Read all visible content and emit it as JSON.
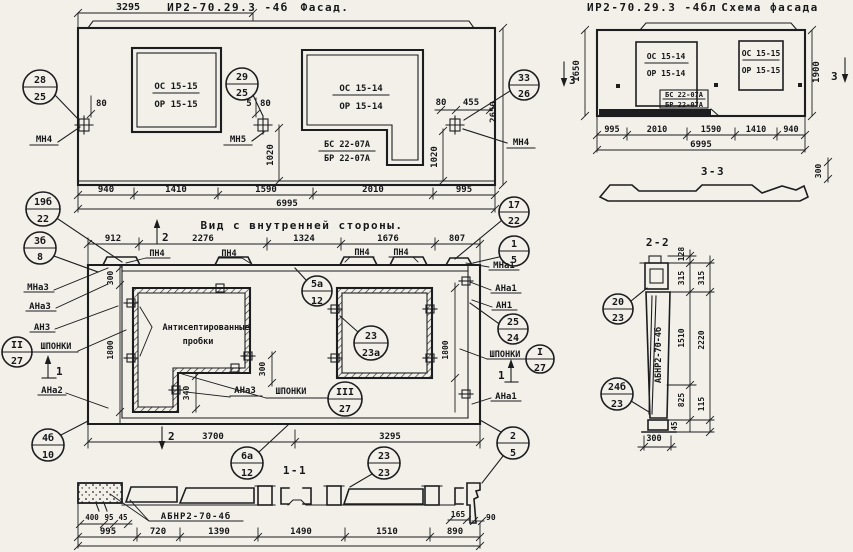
{
  "facade": {
    "mark": "ИР2-70.29.3 -4б",
    "title": "Фасад.",
    "dim_top": "3295",
    "win1_t": "ОС 15-15",
    "win1_b": "ОР 15-15",
    "win2_t": "ОС 15-14",
    "win2_b": "ОР 15-14",
    "door_t": "БС 22-07А",
    "door_b": "БР 22-07А",
    "n28": {
      "t": "28",
      "b": "25"
    },
    "n29": {
      "t": "29",
      "b": "25"
    },
    "n33": {
      "t": "33",
      "b": "26"
    },
    "mn4l": "МН4",
    "mn5": "МН5",
    "mn4r": "МН4",
    "d80l": "80",
    "d5": "5",
    "d80m": "80",
    "d80r": "80",
    "d455": "455",
    "d1020l": "1020",
    "d1020r": "1020",
    "d2650": "2650",
    "db": [
      "940",
      "1410",
      "1590",
      "2010",
      "995"
    ],
    "total": "6995"
  },
  "schema": {
    "mark": "ИР2-70.29.3 -4бл",
    "title": "Схема фасада",
    "win1_t": "ОС 15-14",
    "win1_b": "ОР 15-14",
    "win2_t": "ОС 15-15",
    "win2_b": "ОР 15-15",
    "door_t": "БС 22-07А",
    "door_b": "БР 22-07А",
    "d1650": "1650",
    "d1900": "1900",
    "s3l": "3",
    "s3r": "3",
    "db": [
      "995",
      "2010",
      "1590",
      "1410",
      "940"
    ],
    "total": "6995",
    "sec": "3-3",
    "d300": "300"
  },
  "inner": {
    "title": "Вид с внутренней стороны.",
    "dt": [
      "912",
      "2276",
      "1324",
      "1676",
      "807"
    ],
    "pn": [
      "ПН4",
      "ПН4",
      "ПН4",
      "ПН4"
    ],
    "s2": "2",
    "s1": "1",
    "n19b": {
      "t": "19б",
      "b": "22"
    },
    "n3b": {
      "t": "3б",
      "b": "8"
    },
    "n17": {
      "t": "17",
      "b": "22"
    },
    "n1": {
      "t": "1",
      "b": "5"
    },
    "n5a": {
      "t": "5а",
      "b": "12"
    },
    "n23": {
      "t": "23",
      "b": "23а"
    },
    "nII": {
      "t": "II",
      "b": "27"
    },
    "nIII": {
      "t": "III",
      "b": "27"
    },
    "nI": {
      "t": "I",
      "b": "27"
    },
    "n25": {
      "t": "25",
      "b": "24"
    },
    "n4b": {
      "t": "4б",
      "b": "10"
    },
    "n6a": {
      "t": "6а",
      "b": "12"
    },
    "n2": {
      "t": "2",
      "b": "5"
    },
    "mna3": "МНа3",
    "ana3": "АНа3",
    "an3": "АН3",
    "shp_l": "ШПОНКИ",
    "ana2": "АНа2",
    "ana3m": "АНа3",
    "shp_m": "ШПОНКИ",
    "mna1": "МНа1",
    "ana1": "АНа1",
    "an1": "АН1",
    "shp_r": "ШПОНКИ",
    "ana1b": "АНа1",
    "note1": "Антисептированные",
    "note2": "пробки",
    "d300": "300",
    "d1800l": "1800",
    "d1800r": "1800",
    "d340": "340",
    "d300m": "300",
    "d3700": "3700",
    "d3295": "3295"
  },
  "s11": {
    "label": "1-1",
    "n": {
      "t": "23",
      "b": "23"
    },
    "mark": "АБНР2-70-4б",
    "d400": "400",
    "d95": "95",
    "d45": "45",
    "d165": "165",
    "d90": "90",
    "db": [
      "995",
      "720",
      "1390",
      "1490",
      "1510",
      "890"
    ]
  },
  "s22": {
    "label": "2-2",
    "n20": {
      "t": "20",
      "b": "23"
    },
    "n24": {
      "t": "24б",
      "b": "23"
    },
    "mark": "АБНР2-70-4б",
    "d128": "128",
    "d315a": "315",
    "d315b": "315",
    "d1510": "1510",
    "d2220": "2220",
    "d825": "825",
    "d115": "115",
    "d45": "45",
    "d300": "300"
  }
}
